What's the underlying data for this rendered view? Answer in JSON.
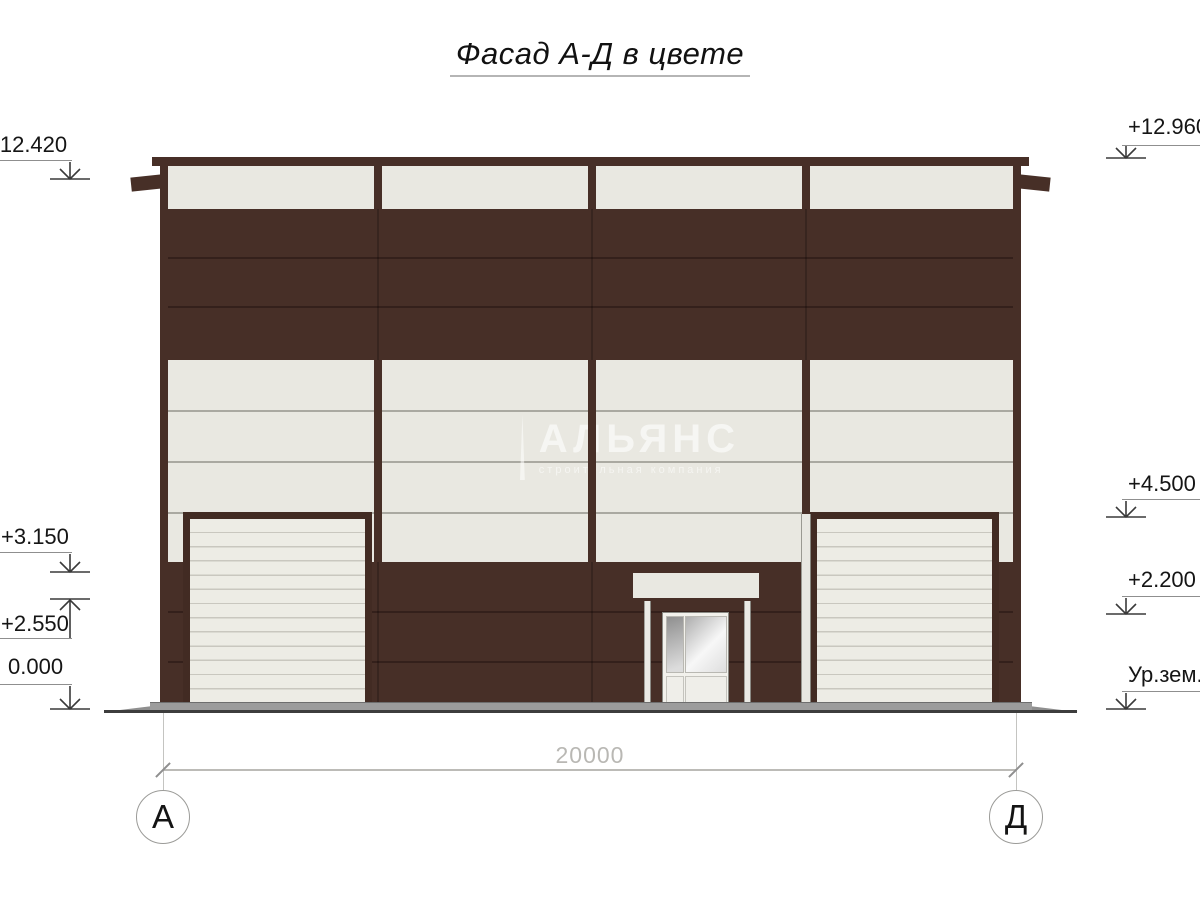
{
  "title": "Фасад А-Д в цвете",
  "watermark": {
    "brand": "АЛЬЯНС",
    "tagline": "строительная компания"
  },
  "elevation_markers": {
    "left": [
      {
        "label": "+12.420",
        "direction": "down"
      },
      {
        "label": "+3.150",
        "direction": "down"
      },
      {
        "label": "+2.550",
        "direction": "up"
      },
      {
        "label": "0.000",
        "direction": "down"
      }
    ],
    "right": [
      {
        "label": "+12.960",
        "direction": "down"
      },
      {
        "label": "+4.500",
        "direction": "down"
      },
      {
        "label": "+2.200",
        "direction": "down"
      },
      {
        "label": "Ур.зем.",
        "direction": "down"
      }
    ]
  },
  "dimension_line": {
    "length_label": "20000"
  },
  "axis_bubbles": {
    "left": "А",
    "right": "Д"
  },
  "colors": {
    "facade_brown": "#472f27",
    "panel_cream": "#e9e8e1",
    "joint_dark": "#34201b",
    "plinth_gray": "#9c9c9c"
  }
}
